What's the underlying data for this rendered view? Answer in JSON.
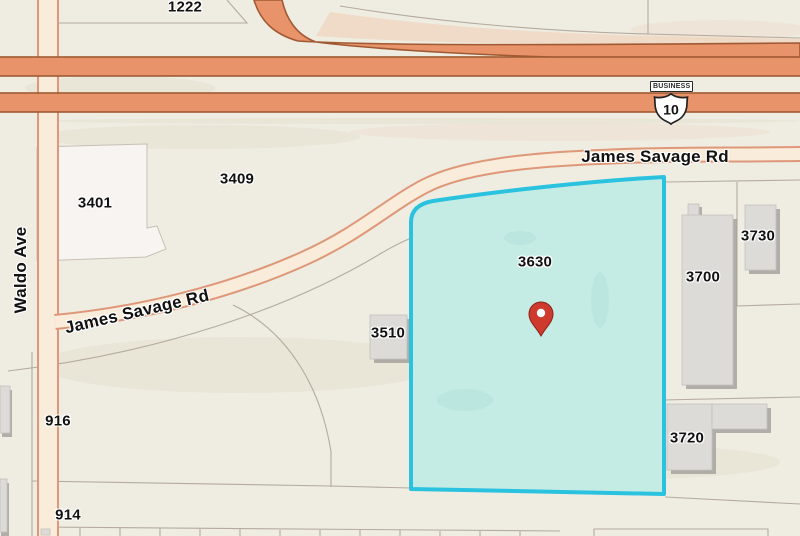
{
  "theme": {
    "bg": "#efece2",
    "road_major_fill": "#e8936a",
    "road_major_border": "#a05a33",
    "road_minor_fill": "#f9ecda",
    "road_minor_border": "#df9779",
    "parcel_line": "#b1a89a",
    "parcel_3401_fill": "#f8f4f1",
    "building_fill": "#dcdbd7",
    "building_shadow": "#a19f9b",
    "highlight_fill": "#c4ece5",
    "highlight_border": "#2bc2e0",
    "label_color": "#111111",
    "pin_color": "#cf3a2e",
    "pin_outline": "#8d2219"
  },
  "labels": {
    "parcels": [
      {
        "id": "1222"
      },
      {
        "id": "3401"
      },
      {
        "id": "3409"
      },
      {
        "id": "3510"
      },
      {
        "id": "3630"
      },
      {
        "id": "3700"
      },
      {
        "id": "3720"
      },
      {
        "id": "3730"
      },
      {
        "id": "916"
      },
      {
        "id": "914"
      }
    ],
    "roads": {
      "james_savage_top": "James Savage Rd",
      "james_savage_curve": "James Savage Rd",
      "waldo": "Waldo Ave"
    }
  },
  "shield": {
    "banner": "BUSINESS",
    "number": "10"
  }
}
